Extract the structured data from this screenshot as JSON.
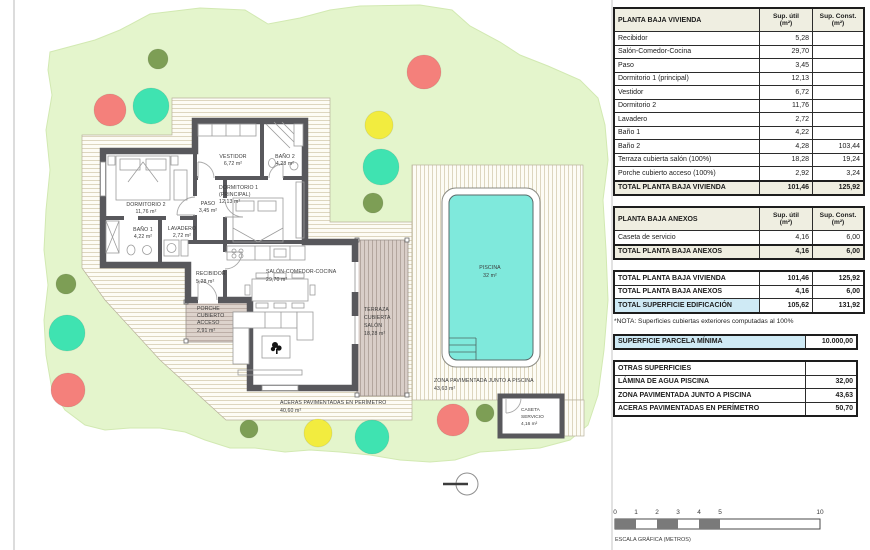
{
  "colors": {
    "site-green": "#e4f5cc",
    "tree-salmon": "#f4807b",
    "tree-teal": "#3fe3b1",
    "tree-yellow": "#f2ec3f",
    "tree-olive": "#7d9e55",
    "pool-water": "#7fe9dc",
    "wall-gray": "#58585c",
    "highlight-blue": "#cfeaf5",
    "header-cream": "#efeee1"
  },
  "plan": {
    "rooms": {
      "vestidor": {
        "name": "VESTIDOR",
        "area": "6,72 m²"
      },
      "bano2": {
        "name": "BAÑO 2",
        "area": "4,28 m²"
      },
      "dormitorio1": {
        "name": "DORMITORIO 1",
        "name2": "(PRINCIPAL)",
        "area": "12,13 m²"
      },
      "dormitorio2": {
        "name": "DORMITORIO 2",
        "area": "11,76 m²"
      },
      "paso": {
        "name": "PASO",
        "area": "3,45 m²"
      },
      "bano1": {
        "name": "BAÑO 1",
        "area": "4,22 m²"
      },
      "lavadero": {
        "name": "LAVADERO",
        "area": "2,72 m²"
      },
      "recibidor": {
        "name": "RECIBIDOR",
        "area": "5,28 m²"
      },
      "salon": {
        "name": "SALÓN-COMEDOR-COCINA",
        "area": "29,70 m²"
      },
      "porche": {
        "l1": "PORCHE",
        "l2": "CUBIERTO",
        "l3": "ACCESO",
        "area": "2,91 m²"
      },
      "terraza": {
        "l1": "TERRAZA",
        "l2": "CUBIERTA",
        "l3": "SALÓN",
        "area": "18,28 m²"
      },
      "aceras": {
        "name": "ACERAS PAVIMENTADAS EN PERÍMETRO",
        "area": "40,60 m²"
      },
      "piscina": {
        "name": "PISCINA",
        "area": "32 m²"
      },
      "zona": {
        "name": "ZONA PAVIMENTADA JUNTO A PISCINA",
        "area": "43,63 m²"
      },
      "caseta": {
        "l1": "CASETA",
        "l2": "SERVICIO",
        "area": "4,16 m²"
      }
    },
    "scale": {
      "ticks": [
        "0",
        "1",
        "2",
        "3",
        "4",
        "5",
        "10"
      ],
      "caption": "ESCALA GRÁFICA (METROS)"
    }
  },
  "tables": [
    {
      "name": "planta-baja-vivienda-table",
      "cls": "",
      "header": [
        "PLANTA BAJA VIVIENDA",
        "Sup. útil\n(m²)",
        "Sup. Const.\n(m²)"
      ],
      "rows": [
        {
          "cells": [
            "Recibidor",
            "5,28",
            ""
          ]
        },
        {
          "cells": [
            "Salón-Comedor-Cocina",
            "29,70",
            ""
          ]
        },
        {
          "cells": [
            "Paso",
            "3,45",
            ""
          ]
        },
        {
          "cells": [
            "Dormitorio 1 (principal)",
            "12,13",
            ""
          ]
        },
        {
          "cells": [
            "Vestidor",
            "6,72",
            ""
          ]
        },
        {
          "cells": [
            "Dormitorio 2",
            "11,76",
            ""
          ]
        },
        {
          "cells": [
            "Lavadero",
            "2,72",
            ""
          ]
        },
        {
          "cells": [
            "Baño 1",
            "4,22",
            ""
          ]
        },
        {
          "cells": [
            "Baño 2",
            "4,28",
            "103,44"
          ]
        },
        {
          "cells": [
            "Terraza cubierta salón (100%)",
            "18,28",
            "19,24"
          ]
        },
        {
          "cells": [
            "Porche cubierto acceso (100%)",
            "2,92",
            "3,24"
          ]
        },
        {
          "cells": [
            "TOTAL PLANTA BAJA VIVIENDA",
            "101,46",
            "125,92"
          ],
          "cls": "total"
        }
      ]
    },
    {
      "name": "planta-baja-anexos-table",
      "cls": "",
      "header": [
        "PLANTA BAJA ANEXOS",
        "Sup. útil\n(m²)",
        "Sup. Const.\n(m²)"
      ],
      "rows": [
        {
          "cells": [
            "Caseta de servicio",
            "4,16",
            "6,00"
          ]
        },
        {
          "cells": [
            "TOTAL PLANTA BAJA ANEXOS",
            "4,16",
            "6,00"
          ],
          "cls": "total"
        }
      ]
    },
    {
      "name": "totales-table",
      "cls": "",
      "header": null,
      "rows": [
        {
          "cells": [
            "TOTAL PLANTA BAJA VIVIENDA",
            "101,46",
            "125,92"
          ],
          "cls": "b"
        },
        {
          "cells": [
            "TOTAL PLANTA BAJA ANEXOS",
            "4,16",
            "6,00"
          ],
          "cls": "b"
        },
        {
          "cells": [
            "TOTAL SUPERFICIE EDIFICACIÓN",
            "105,62",
            "131,92"
          ],
          "cls": "b",
          "hl": true
        }
      ],
      "note": "*NOTA: Superficies cubiertas exteriores computadas al 100%"
    },
    {
      "name": "parcela-minima-table",
      "cls": "two",
      "header": null,
      "rows": [
        {
          "cells": [
            "SUPERFICIE PARCELA MÍNIMA",
            "10.000,00"
          ],
          "cls": "b",
          "hl": true
        }
      ]
    },
    {
      "name": "otras-superficies-table",
      "cls": "two",
      "header": null,
      "rows": [
        {
          "cells": [
            "OTRAS SUPERFICIES",
            ""
          ],
          "cls": "b"
        },
        {
          "cells": [
            "LÁMINA DE AGUA PISCINA",
            "32,00"
          ],
          "cls": "b"
        },
        {
          "cells": [
            "ZONA PAVIMENTADA JUNTO A PISCINA",
            "43,63"
          ],
          "cls": "b"
        },
        {
          "cells": [
            "ACERAS PAVIMENTADAS EN PERÍMETRO",
            "50,70"
          ],
          "cls": "b"
        }
      ]
    }
  ]
}
